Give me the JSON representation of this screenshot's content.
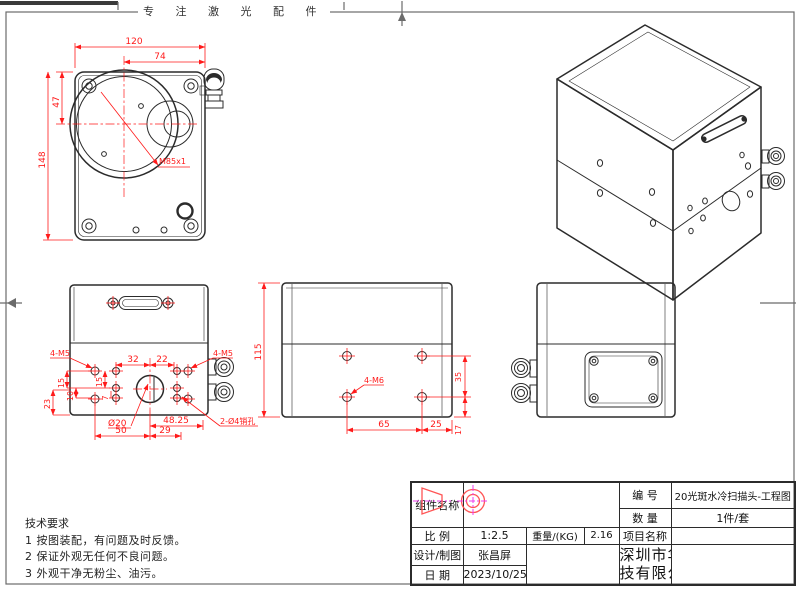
{
  "banner": {
    "text": "专 注 激 光 配 件"
  },
  "views": {
    "front": {
      "dim_width": "120",
      "dim_width_to_center": "74",
      "dim_center_top": "47",
      "dim_height": "148",
      "thread_label": "M85x1"
    },
    "bottom": {
      "label_m5_left": "4-M5",
      "label_m5_right": "4-M5",
      "label_pinholes": "2-Ø4销孔",
      "dim_32": "32",
      "dim_22": "22",
      "dim_15_left": "15",
      "dim_15_inner": "15",
      "dim_10": "10",
      "dim_7": "7",
      "dim_23": "23",
      "dim_d20": "Ø20",
      "dim_50": "50",
      "dim_29": "29",
      "dim_4825": "48.25"
    },
    "side": {
      "dim_115": "115",
      "label_m6": "4-M6",
      "dim_35": "35",
      "dim_65": "65",
      "dim_25": "25",
      "dim_17": "17"
    }
  },
  "tech_requirements": {
    "title": "技术要求",
    "items": [
      "1  按图装配，有问题及时反馈。",
      "2  保证外观无任何不良问题。",
      "3  外观干净无粉尘、油污。"
    ]
  },
  "title_block": {
    "component_label": "组件名称",
    "component_value": "",
    "number_label": "编  号",
    "number_value": "20光斑水冷扫描头-工程图",
    "qty_label": "数  量",
    "qty_value": "1件/套",
    "scale_label": "比  例",
    "scale_value": "1:2.5",
    "weight_label": "重量/(KG)",
    "weight_value": "2.16",
    "project_label": "项目名称",
    "project_value": "",
    "designer_label": "设计/制图",
    "designer_value": "张昌屏",
    "date_label": "日  期",
    "date_value": "2023/10/25",
    "company_line1": "深圳市华鹏艾伟科",
    "company_line2": "技有限公司"
  },
  "colors": {
    "dimension": "#ff1a1a",
    "centerline_magenta": "#ee3cee",
    "outline": "#2b2b2b"
  }
}
